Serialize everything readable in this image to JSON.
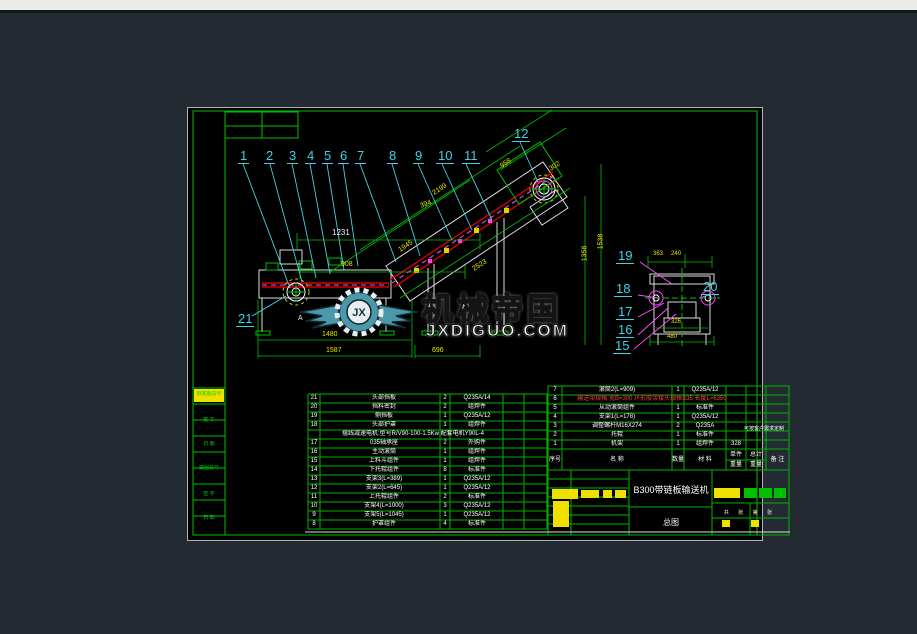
{
  "callouts": [
    "1",
    "2",
    "3",
    "4",
    "5",
    "6",
    "7",
    "8",
    "9",
    "10",
    "11",
    "12",
    "19",
    "18",
    "17",
    "16",
    "15",
    "20",
    "21"
  ],
  "dimensions": {
    "d1231": "1231",
    "d908": "908",
    "d394": "394",
    "d2199": "2199",
    "d1945": "1945",
    "d2523": "2523",
    "d958": "958",
    "d302": "302",
    "d1358": "1358",
    "d1538": "1538",
    "d1480": "1480",
    "d1587": "1587",
    "d696": "696",
    "d363": "363",
    "d240": "240",
    "d326": "326",
    "d480": "480",
    "label_a": "A"
  },
  "watermark": {
    "title": "机械帝国",
    "site": "JXDIGUO.COM",
    "initials": "JX"
  },
  "frame_strip": {
    "labels": [
      "旧底图总号",
      "签 字",
      "日 期",
      "底图总号",
      "签 字",
      "日 期"
    ]
  },
  "bom_left": {
    "rows": [
      {
        "seq": "21",
        "name": "头部挡板",
        "qty": "2",
        "material": "Q235A/14"
      },
      {
        "seq": "20",
        "name": "挡料密封",
        "qty": "2",
        "material": "组焊件"
      },
      {
        "seq": "19",
        "name": "侧挡板",
        "qty": "1",
        "material": "Q235A/12"
      },
      {
        "seq": "18",
        "name": "头部护罩",
        "qty": "1",
        "material": "组焊件"
      },
      {
        "seq": "",
        "name": "摆线减速电机:型号R/V90-100-1.5Kw 配套电机Y90L-4",
        "qty": "",
        "material": ""
      },
      {
        "seq": "17",
        "name": "035轴承座",
        "qty": "2",
        "material": "外购件"
      },
      {
        "seq": "16",
        "name": "主动滚筒",
        "qty": "1",
        "material": "组焊件"
      },
      {
        "seq": "15",
        "name": "上料斗组件",
        "qty": "1",
        "material": "组焊件"
      },
      {
        "seq": "14",
        "name": "下托辊组件",
        "qty": "8",
        "material": "标准件"
      },
      {
        "seq": "13",
        "name": "支架3(L=389)",
        "qty": "1",
        "material": "Q235A/12"
      },
      {
        "seq": "12",
        "name": "支架2(L=645)",
        "qty": "1",
        "material": "Q235A/12"
      },
      {
        "seq": "11",
        "name": "上托辊组件",
        "qty": "2",
        "material": "标准件"
      },
      {
        "seq": "10",
        "name": "支架4(L=1000)",
        "qty": "3",
        "material": "Q235A/12"
      },
      {
        "seq": "9",
        "name": "支架5(L=1045)",
        "qty": "1",
        "material": "Q235A/12"
      },
      {
        "seq": "8",
        "name": "护罩组件",
        "qty": "4",
        "material": "标准件"
      }
    ]
  },
  "bom_right": {
    "rows": [
      {
        "seq": "7",
        "name": "滚筒2(L=909)",
        "qty": "1",
        "material": "Q235A/12",
        "w1": ""
      },
      {
        "seq": "6",
        "name": "输送带规格:宽B=300 环形胶带接头规格S35 长度L=6350",
        "qty": "",
        "material": "",
        "w1": ""
      },
      {
        "seq": "5",
        "name": "从动滚筒组件",
        "qty": "1",
        "material": "标准件",
        "w1": ""
      },
      {
        "seq": "4",
        "name": "支架1(L=178)",
        "qty": "1",
        "material": "Q235A/12",
        "w1": ""
      },
      {
        "seq": "3",
        "name": "调整螺杆M16X274",
        "qty": "2",
        "material": "Q235A",
        "w1": ""
      },
      {
        "seq": "2",
        "name": "托辊",
        "qty": "1",
        "material": "标准件",
        "w1": ""
      },
      {
        "seq": "1",
        "name": "机架",
        "qty": "1",
        "material": "组焊件",
        "w1": "328"
      }
    ],
    "header": {
      "seq": "序号",
      "name": "名  称",
      "qty": "数量",
      "material": "材  料",
      "w1a": "单件",
      "w2a": "总计",
      "wb": "重量",
      "remark": "备 注"
    },
    "remark_note": "可按客户需求定制"
  },
  "title_block": {
    "title": "B300带链板输送机",
    "sheet_type": "总图",
    "pages": "共 张 第 张"
  }
}
